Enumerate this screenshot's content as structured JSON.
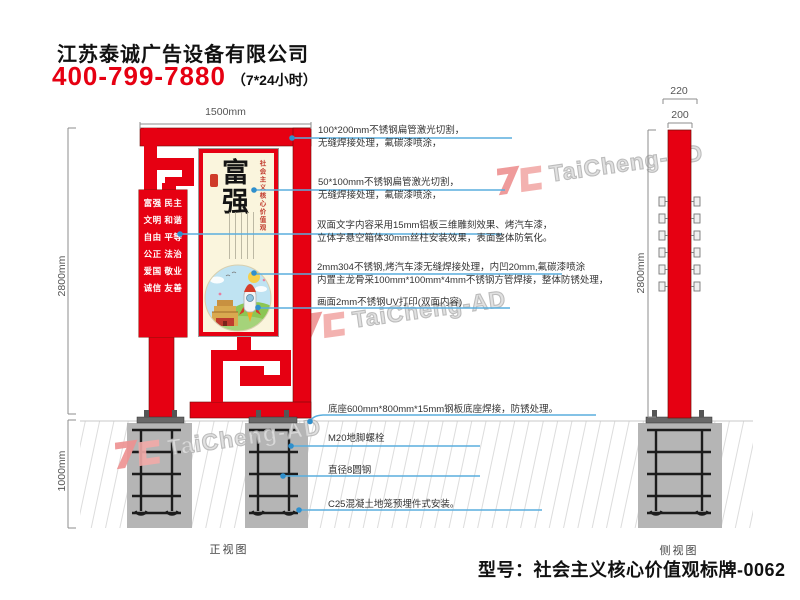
{
  "header": {
    "company": "江苏泰诚广告设备有限公司",
    "phone": "400-799-7880",
    "hours": "（7*24小时）"
  },
  "watermark": {
    "text": "TaiCheng-AD"
  },
  "front_view": {
    "label": "正视图",
    "dim_width": "1500mm",
    "dim_height": "2800mm",
    "dim_underground": "1000mm",
    "values_panel": [
      "富强 民主",
      "文明 和谐",
      "自由 平等",
      "公正 法治",
      "爱国 敬业",
      "诚信 友善"
    ],
    "poster": {
      "title": "富强",
      "subtitle": "社会主义核心价值观"
    }
  },
  "side_view": {
    "label": "侧视图",
    "dim_outer": "220",
    "dim_inner": "200",
    "dim_height": "2800mm"
  },
  "annotations": {
    "a1": {
      "line1": "100*200mm不锈钢扁管激光切割，",
      "line2": "无缝焊接处理，氟碳漆喷涂，"
    },
    "a2": {
      "line1": "50*100mm不锈钢扁管激光切割，",
      "line2": "无缝焊接处理，氟碳漆喷涂，"
    },
    "a3": {
      "line1": "双面文字内容采用15mm铝板三维雕刻效果、烤汽车漆，",
      "line2": "立体字悬空箱体30mm丝柱安装效果，表面整体防氧化。"
    },
    "a4": {
      "line1": "2mm304不锈钢,烤汽车漆无缝焊接处理，内凹20mm,氟碳漆喷涂",
      "line2": "内置主龙骨采100mm*100mm*4mm不锈钢方管焊接，整体防锈处理，"
    },
    "a5": {
      "line1": "画面2mm不锈钢UV打印(双面内容)"
    },
    "a6": {
      "line1": "底座600mm*800mm*15mm钢板底座焊接，防锈处理。"
    },
    "a7": {
      "line1": "M20地脚螺栓"
    },
    "a8": {
      "line1": "直径8圆钢"
    },
    "a9": {
      "line1": "C25混凝土地笼预埋件式安装。"
    }
  },
  "footer": {
    "model": "型号：社会主义核心价值观标牌-0062"
  },
  "colors": {
    "red": "#e60012",
    "leader_blue": "#5aaede",
    "cream": "#faf5dd",
    "watermark_pink": "#ef9a9a"
  }
}
